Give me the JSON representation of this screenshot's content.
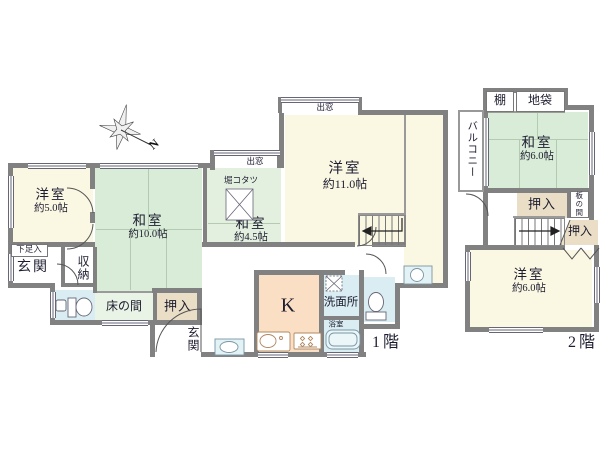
{
  "floor1": {
    "label": "1階",
    "rooms": {
      "yoshitsu5": {
        "name": "洋室",
        "area": "約5.0帖"
      },
      "washitsu10": {
        "name": "和室",
        "area": "約10.0帖"
      },
      "washitsu45": {
        "name": "和室",
        "area": "約4.5帖"
      },
      "yoshitsu11": {
        "name": "洋室",
        "area": "約11.0帖"
      },
      "kitchen": {
        "name": "K"
      },
      "senmenjo": {
        "name": "洗面所"
      },
      "yokushitsu": {
        "name": "浴室"
      },
      "genkan_hall": {
        "name": "玄関"
      },
      "genkan_entry": {
        "name": "玄関"
      },
      "gesokuiri": {
        "name": "下足入"
      },
      "shuunou": {
        "name": "収納"
      },
      "tokonoma": {
        "name": "床の間"
      },
      "oshiire": {
        "name": "押入"
      },
      "horikotatsu": {
        "name": "堀コタツ"
      },
      "demado_washitsu": {
        "name": "出窓"
      },
      "demado_yoshitsu": {
        "name": "出窓"
      }
    }
  },
  "floor2": {
    "label": "2階",
    "rooms": {
      "washitsu6": {
        "name": "和室",
        "area": "約6.0帖"
      },
      "yoshitsu6": {
        "name": "洋室",
        "area": "約6.0帖"
      },
      "tana": {
        "name": "棚"
      },
      "jibukuro": {
        "name": "地袋"
      },
      "balcony": {
        "name": "バルコニー"
      },
      "oshiire_upper": {
        "name": "押入"
      },
      "oshiire_lower": {
        "name": "押入"
      },
      "itanoma": {
        "name": "板の間"
      }
    }
  },
  "compass": {
    "label": "N"
  },
  "colors": {
    "wall": "#818181",
    "yoshitsu": "#FAF7E3",
    "washitsu": "#D9ECD7",
    "washitsu_light": "#E4F0DF",
    "tokonoma": "#EAF4E6",
    "oshiire": "#EADFC6",
    "kitchen": "#FADFC5",
    "water": "#D9EDF2",
    "line": "#9a9a9a",
    "tatami_line": "#b4cbb1",
    "text": "#1d1d30"
  }
}
